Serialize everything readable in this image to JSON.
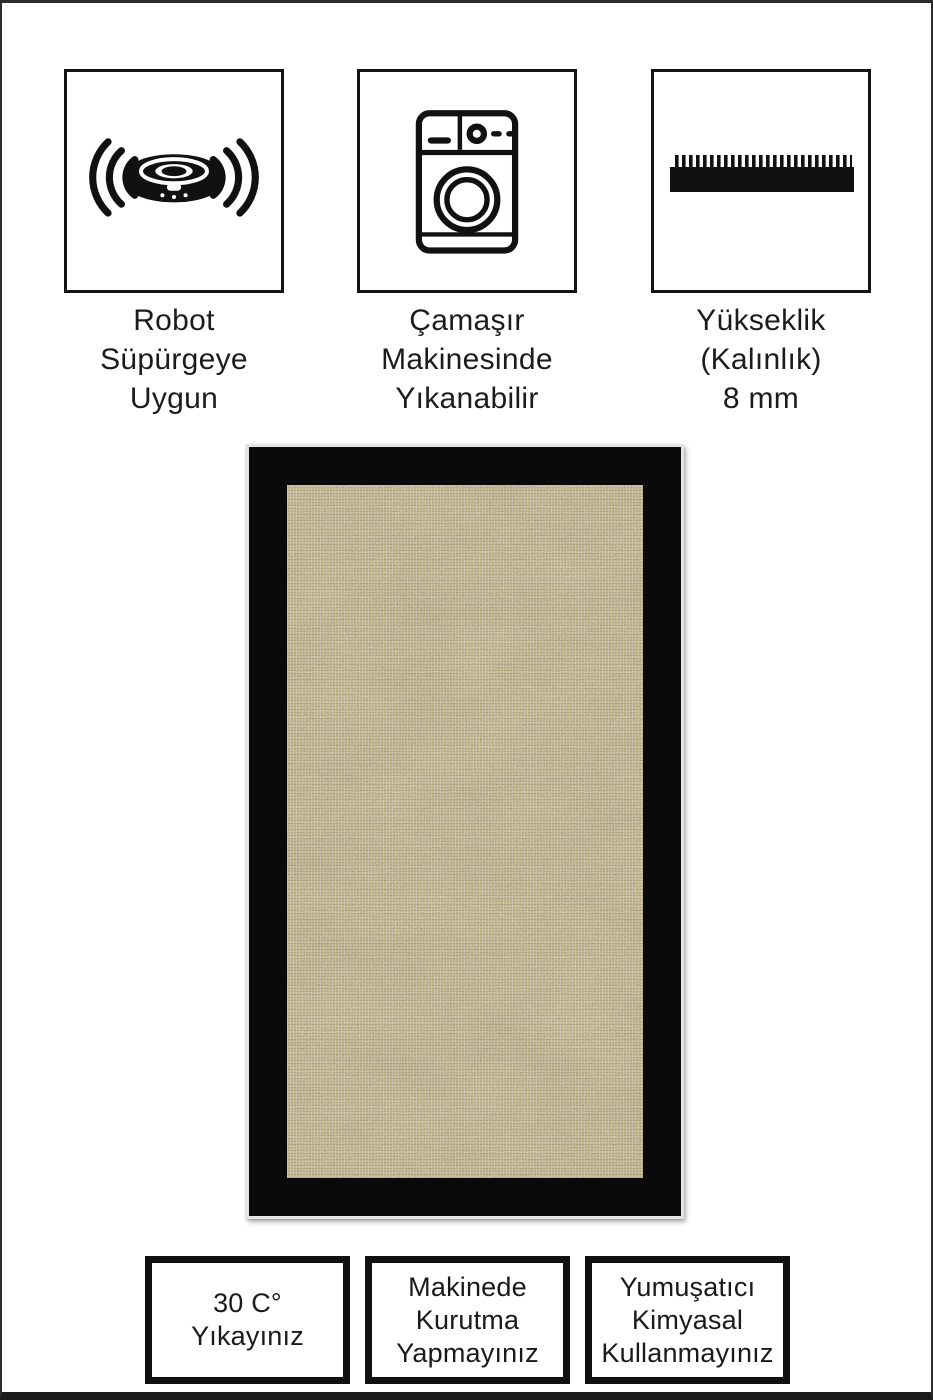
{
  "page": {
    "background_color": "#ffffff",
    "frame_color": "#2c2c2c",
    "text_color": "#1e1e1e"
  },
  "features": [
    {
      "icon": "robot-vacuum-icon",
      "label": "Robot\nSüpürgeye\nUygun"
    },
    {
      "icon": "washing-machine-icon",
      "label": "Çamaşır\nMakinesinde\nYıkanabilir"
    },
    {
      "icon": "pile-height-icon",
      "label": "Yükseklik\n(Kalınlık)\n8 mm"
    }
  ],
  "product": {
    "kind": "rug-photo",
    "border_color": "#0a0a0a",
    "field_color": "#b19e74",
    "edge_color": "#e4e4e4"
  },
  "care_instructions": [
    {
      "label": "30 C°\nYıkayınız"
    },
    {
      "label": "Makinede\nKurutma\nYapmayınız"
    },
    {
      "label": "Yumuşatıcı\nKimyasal\nKullanmayınız"
    }
  ]
}
